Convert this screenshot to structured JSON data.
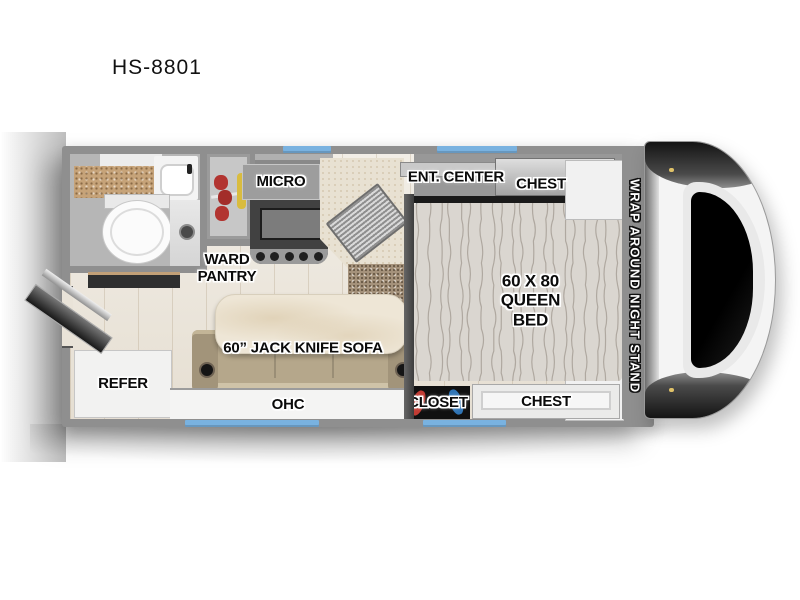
{
  "title": "HS-8801",
  "floorplan": {
    "labels": {
      "micro": "MICRO",
      "ward_pantry": "WARD\nPANTRY",
      "ent_center": "ENT. CENTER",
      "chest_top": "CHEST",
      "queen_bed": "60 X 80\nQUEEN BED",
      "night_stand": "WRAP AROUND NIGHT STAND",
      "refer": "REFER",
      "sofa": "60” JACK KNIFE SOFA",
      "ohc": "OHC",
      "closet": "CLOSET",
      "chest_bottom": "CHEST"
    },
    "colors": {
      "wall": "#8f8f8f",
      "window": "#79b2e0",
      "wood_floor": "#ebe5da",
      "carpet": "#a5927b",
      "counter_tan": "#c6a379",
      "bed": "#dad6d0",
      "sofa": "#b5a78b",
      "tv_accent": "#4a7fb5"
    }
  }
}
